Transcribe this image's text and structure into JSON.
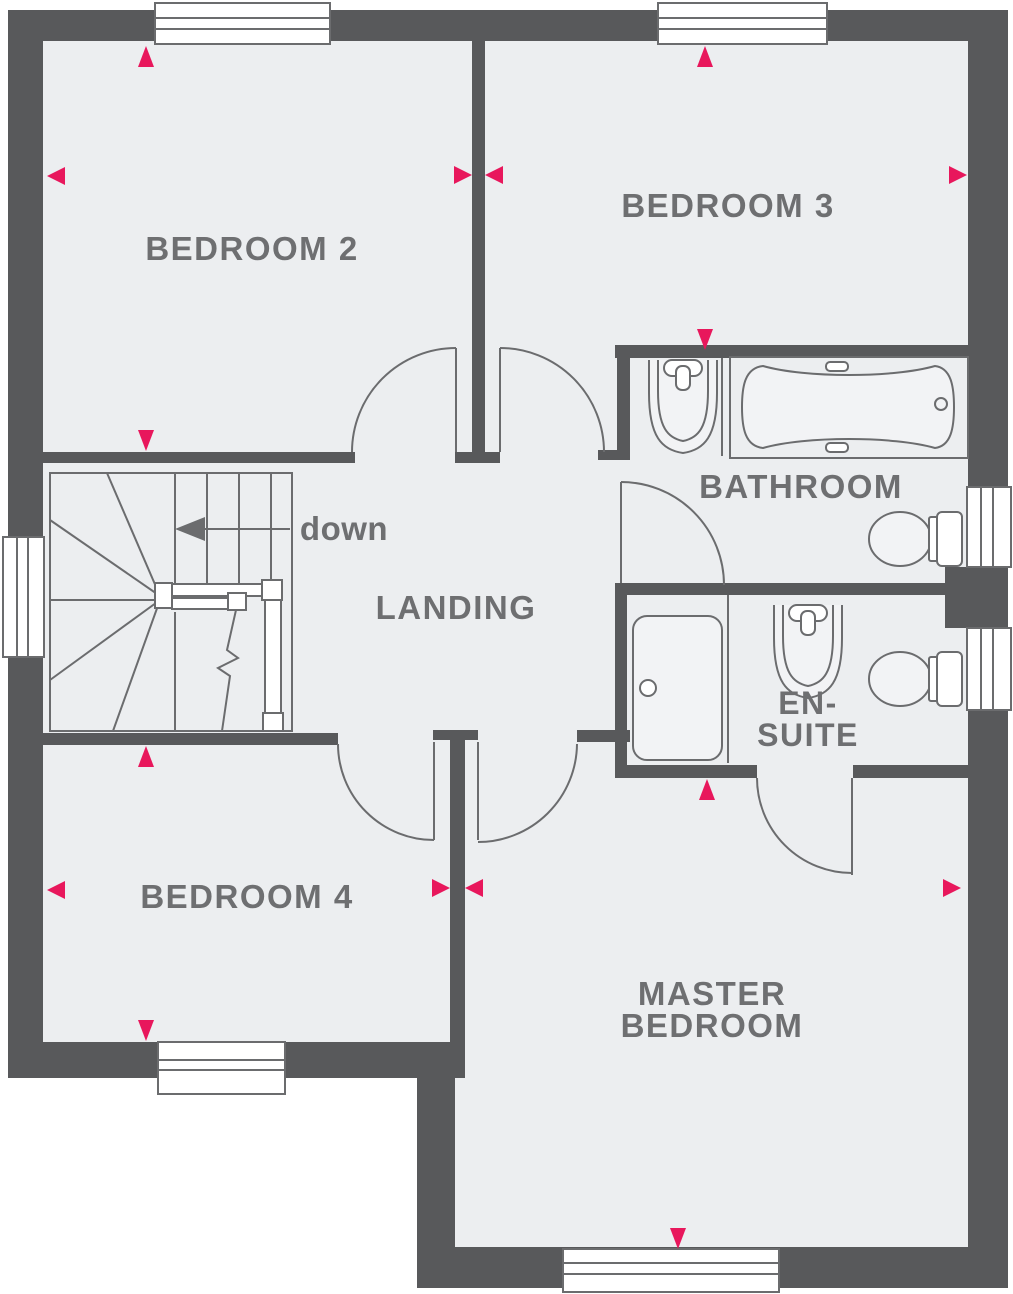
{
  "colors": {
    "wall": "#58595B",
    "floor": "#ECEEF0",
    "line": "#6B6C6E",
    "accent": "#E8175C",
    "text": "#6E6F71",
    "fixture": "#F2F3F5"
  },
  "labels": {
    "bedroom2": "BEDROOM 2",
    "bedroom3": "BEDROOM 3",
    "bathroom": "BATHROOM",
    "landing": "LANDING",
    "ensuite_line1": "EN-",
    "ensuite_line2": "SUITE",
    "bedroom4": "BEDROOM 4",
    "master_line1": "MASTER",
    "master_line2": "BEDROOM",
    "stairs_direction": "down"
  },
  "fixtures": [
    "bath",
    "bathroom-sink",
    "bathroom-toilet",
    "shower",
    "ensuite-sink",
    "ensuite-toilet",
    "staircase"
  ],
  "window_count": 7,
  "door_count": 6
}
